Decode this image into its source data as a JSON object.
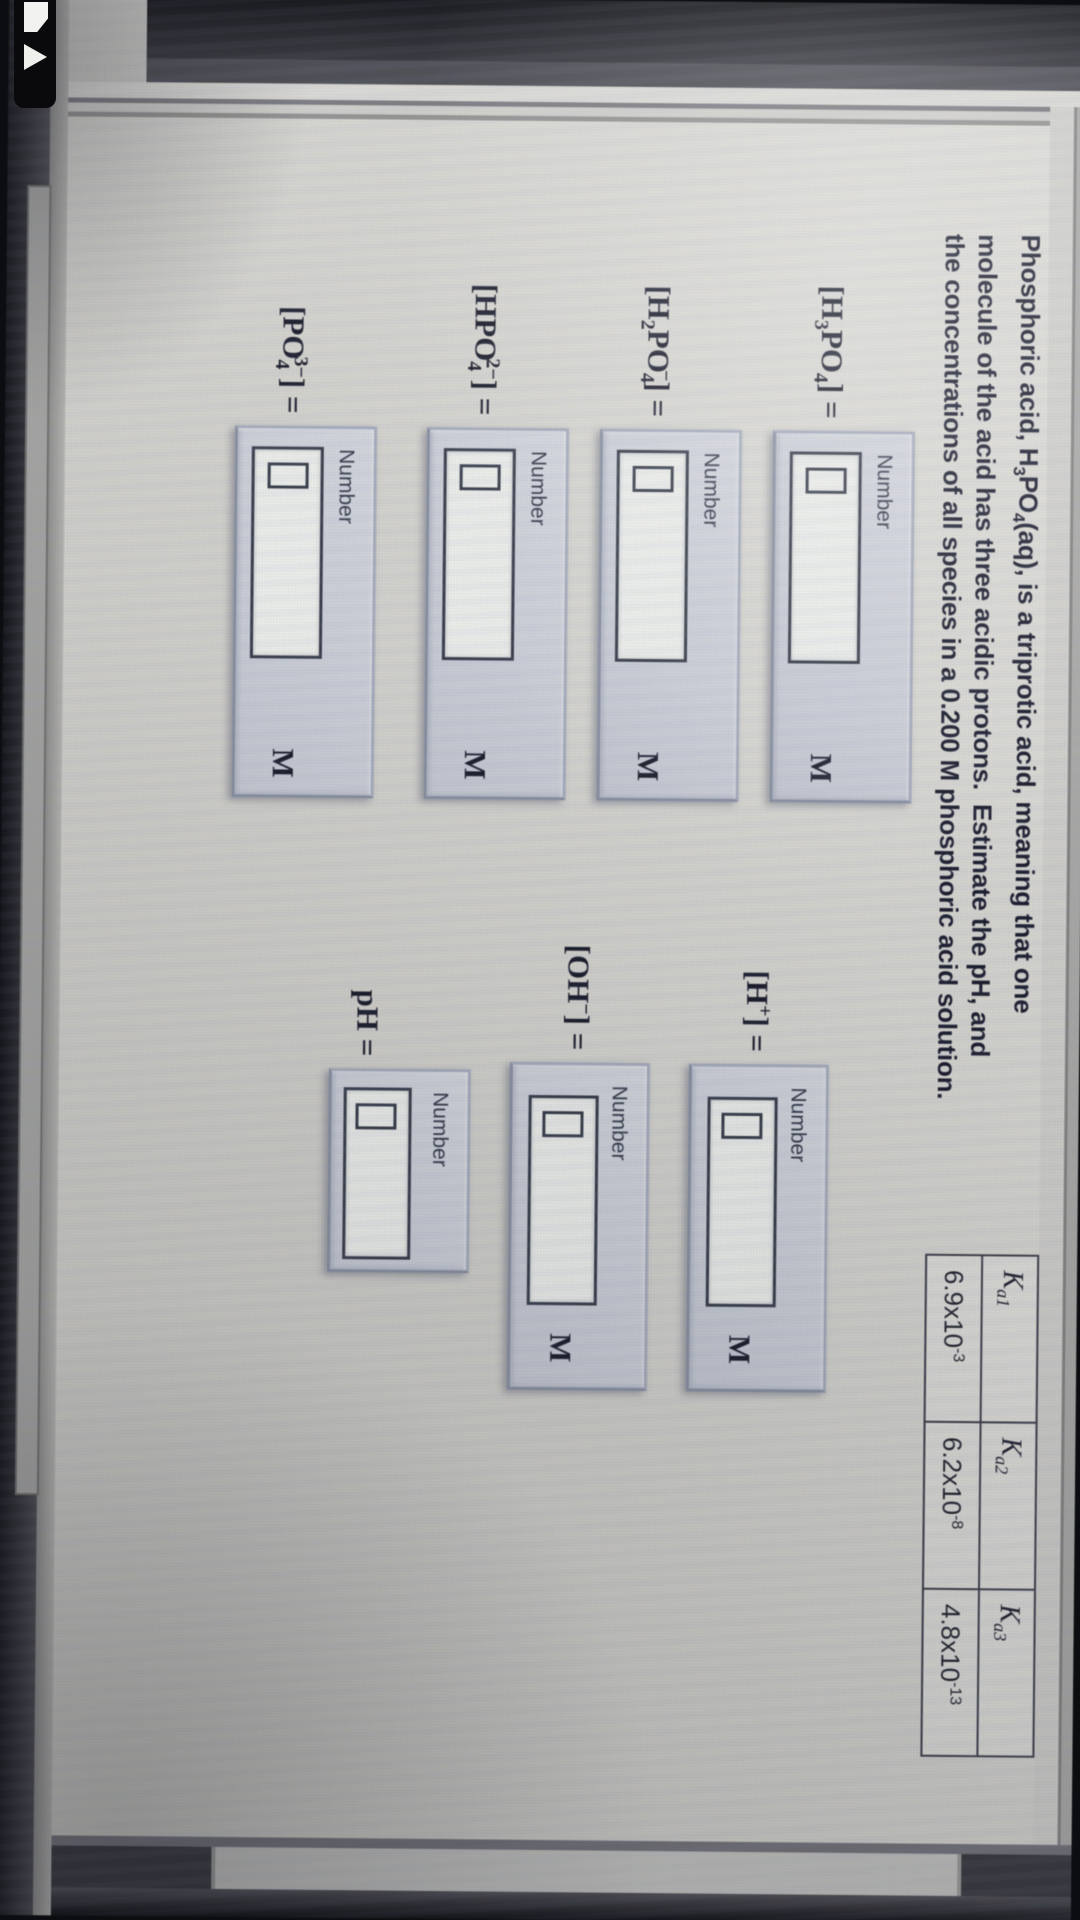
{
  "problem": {
    "lines": [
      [
        {
          "t": "n",
          "v": "Phosphoric acid, H"
        },
        {
          "t": "sub",
          "v": "3"
        },
        {
          "t": "n",
          "v": "PO"
        },
        {
          "t": "sub",
          "v": "4"
        },
        {
          "t": "n",
          "v": "(aq), is a triprotic acid, meaning that one"
        }
      ],
      [
        {
          "t": "n",
          "v": "molecule of the acid has three acidic protons.  Estimate the pH, and"
        }
      ],
      [
        {
          "t": "n",
          "v": "the concentrations of all species in a 0.200 M phosphoric acid solution."
        }
      ]
    ]
  },
  "ka_table": {
    "headers": [
      {
        "base": "K",
        "sub": "a1"
      },
      {
        "base": "K",
        "sub": "a2"
      },
      {
        "base": "K",
        "sub": "a3"
      }
    ],
    "values": [
      {
        "base": "6.9x10",
        "exp": "-3"
      },
      {
        "base": "6.2x10",
        "exp": "-8"
      },
      {
        "base": "4.8x10",
        "exp": "-13"
      }
    ]
  },
  "fields": [
    {
      "id": "h3po4",
      "formula": [
        {
          "t": "n",
          "v": "[H"
        },
        {
          "t": "sub",
          "v": "3"
        },
        {
          "t": "n",
          "v": "PO"
        },
        {
          "t": "sub",
          "v": "4"
        },
        {
          "t": "n",
          "v": "] ="
        }
      ],
      "box_label": "Number",
      "value": "",
      "unit": "M"
    },
    {
      "id": "h2po4",
      "formula": [
        {
          "t": "n",
          "v": "[H"
        },
        {
          "t": "sub",
          "v": "2"
        },
        {
          "t": "n",
          "v": "PO"
        },
        {
          "t": "sub",
          "v": "4"
        },
        {
          "t": "sup",
          "v": "−"
        },
        {
          "t": "n",
          "v": "] ="
        }
      ],
      "box_label": "Number",
      "value": "",
      "unit": "M"
    },
    {
      "id": "hpo4",
      "formula": [
        {
          "t": "n",
          "v": "[HPO"
        },
        {
          "t": "sub",
          "v": "4"
        },
        {
          "t": "sup",
          "v": "2−"
        },
        {
          "t": "n",
          "v": "] ="
        }
      ],
      "box_label": "Number",
      "value": "",
      "unit": "M"
    },
    {
      "id": "po4",
      "formula": [
        {
          "t": "n",
          "v": "[PO"
        },
        {
          "t": "sub",
          "v": "4"
        },
        {
          "t": "sup",
          "v": "3−"
        },
        {
          "t": "n",
          "v": "] ="
        }
      ],
      "box_label": "Number",
      "value": "",
      "unit": "M"
    },
    {
      "id": "hplus",
      "formula": [
        {
          "t": "n",
          "v": "[H"
        },
        {
          "t": "sup",
          "v": "+"
        },
        {
          "t": "n",
          "v": "] ="
        }
      ],
      "box_label": "Number",
      "value": "",
      "unit": "M"
    },
    {
      "id": "oh",
      "formula": [
        {
          "t": "n",
          "v": "[OH"
        },
        {
          "t": "sup",
          "v": "−"
        },
        {
          "t": "n",
          "v": "] ="
        }
      ],
      "box_label": "Number",
      "value": "",
      "unit": "M"
    },
    {
      "id": "ph",
      "formula": [
        {
          "t": "n",
          "v": "pH ="
        }
      ],
      "box_label": "Number",
      "value": "",
      "unit": ""
    }
  ],
  "colors": {
    "page_bg": "#d5d4cd",
    "panel_bg": "#cbcfd7",
    "input_bg": "#eceee9",
    "text": "#1a1c2e",
    "bezel": "#0c0d10"
  }
}
